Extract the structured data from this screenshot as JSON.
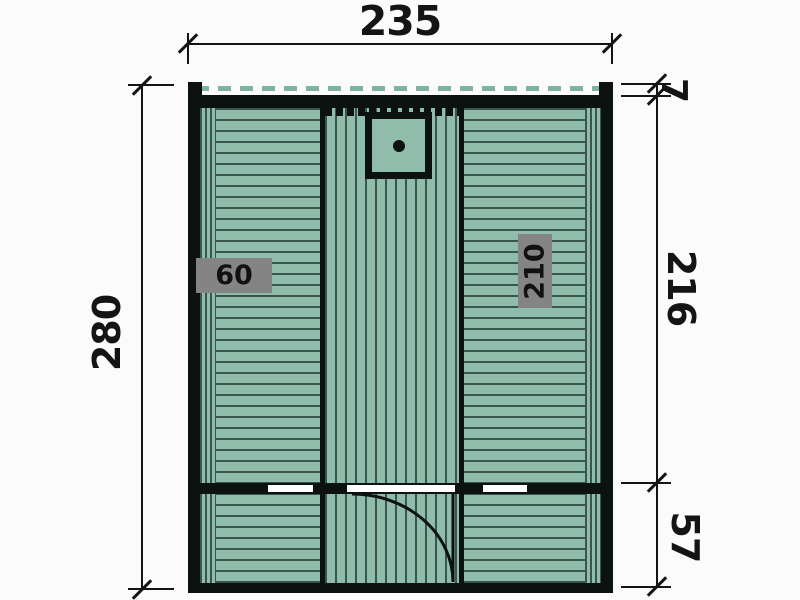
{
  "dimensions": {
    "width_top": "235",
    "depth_left": "280",
    "roof_overhang": "7",
    "main_room_depth": "216",
    "front_section_depth": "57"
  },
  "interior": {
    "left_bench_width": "60",
    "right_bench_length": "210"
  },
  "icons": {
    "heater_icon": "square-with-center-dot",
    "door_icon": "quarter-circle-swing-arc",
    "tick_icon": "45-degree-slash",
    "roof_line_icon": "dashed-roof-overhang-line"
  },
  "colors": {
    "plank_green": "#8fbcab",
    "groove_dark": "#3a554c",
    "wall_black": "#0c120f",
    "badge_gray": "#848484",
    "dim_black": "#141414",
    "background": "#fbfbfb",
    "roof_dash_green": "#7fb2a1"
  }
}
